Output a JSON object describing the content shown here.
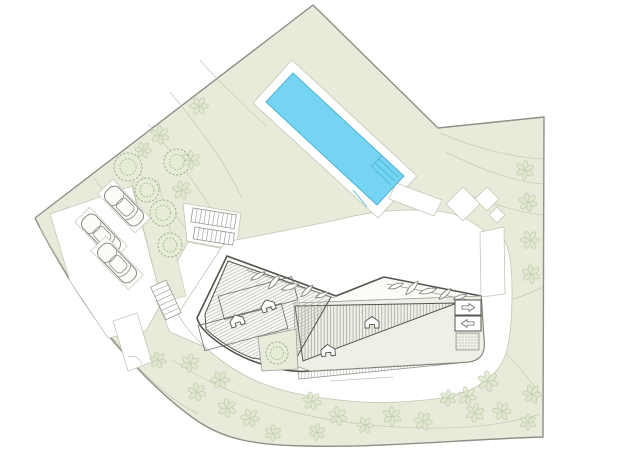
{
  "meta": {
    "canvas_width": 640,
    "canvas_height": 452
  },
  "colors": {
    "paper": "#ffffff",
    "site_green": "#e8ebd9",
    "white": "#ffffff",
    "pool_blue": "#74d4f2",
    "pool_line": "#4fb3d4",
    "boundary": "#8f8f88",
    "line_light": "#c2c7b5",
    "line_mid": "#9a9a92",
    "line_dark": "#54544e",
    "hatch": "#a9a9a1",
    "stripe2": "#b3b3ab",
    "tree_detail": "#9fae8e",
    "tree_detail_fill": "#e6ecd6",
    "tree_light": "#bcc7aa",
    "tree_light_fill": "#e0e8cd",
    "building_fill": "#fbfbf8",
    "plain_roof": "#efefe8",
    "car_stroke": "#8a8a84"
  },
  "site": {
    "outline": "M313,5 L438,128 L544,117 L543,437 C470,439 380,448 305,446 C250,445 222,438 196,420 C163,397 130,362 104,330 C82,302 52,252 35,218 Z",
    "inner_wall": "M40,227 C64,272 95,318 124,352 C152,384 175,402 198,414"
  },
  "contours": [
    "M170,92 C198,126 224,160 242,198",
    "M148,124 C178,160 202,190 218,222",
    "M124,154 C156,194 178,216 192,238",
    "M94,178 C122,214 142,240 152,258",
    "M66,206 C96,246 116,270 130,290",
    "M200,60 C224,88 248,108 266,126",
    "M440,133 C472,147 510,157 543,159",
    "M446,152 C482,170 516,182 543,184",
    "M462,192 C496,206 524,213 543,215",
    "M505,302 C518,298 532,292 543,287",
    "M505,352 C520,368 532,382 541,396",
    "M172,360 C244,406 324,426 424,428 C472,429 512,423 540,414"
  ],
  "white_areas": [
    {
      "name": "parking-area",
      "d": "M50,214 L132,186 L162,302 L146,331 L108,338 L70,281 Z"
    },
    {
      "name": "corridor-path",
      "d": "M156,300 L188,242 L240,252 L212,350 L170,332 Z"
    },
    {
      "name": "stairs-pad",
      "d": "M183,203 L241,213 L236,250 L187,241 Z"
    },
    {
      "name": "entrance-structure",
      "d": "M113,321 L137,313 L152,362 L128,371 Z"
    },
    {
      "name": "driveway-and-road",
      "d": "M225,242 C268,234 310,226 345,218 C378,210 405,209 437,211 C458,213 472,221 483,230 C494,235 501,238 505,241 C510,253 512,266 512,292 C512,318 510,340 506,353 C501,369 491,379 470,390 C452,398 430,400 400,402 C368,404 328,400 294,393 C262,386 238,374 214,355 C197,341 184,326 178,314 Z"
    },
    {
      "name": "pool-deck",
      "d": "M292,60 L417,176 L378,218 L253,103 Z"
    },
    {
      "name": "walkway-chevron",
      "d": "M396,183 L442,200 L434,216 L389,199 Z"
    },
    {
      "name": "walkway-diamond-1",
      "d": "M463,187 L480,204 L463,221 L446,204 Z"
    },
    {
      "name": "walkway-diamond-2",
      "d": "M487,187 L499,199 L487,211 L475,199 Z"
    },
    {
      "name": "walkway-diamond-3",
      "d": "M497,207 L505,215 L497,223 L489,215 Z"
    },
    {
      "name": "walkway-vertical",
      "d": "M480,232 L504,227 L505,294 L481,297 Z"
    }
  ],
  "green_islands": [
    {
      "name": "tree-strip",
      "d": "M132,183 L158,180 L186,296 L162,302 Z"
    }
  ],
  "entrance_arc": "M128,357 A11,11 0 0 1 142,364",
  "pool": {
    "body": "M293,73 L404,176 L377,205 L266,102 Z",
    "detail_lines": [
      "M379,159 L398,177",
      "M375,163 L395,181",
      "M372,167 L391,185",
      "M382,155 L371,167",
      "M353,190 L367,207"
    ]
  },
  "building": {
    "lower_band": "M298,366 L458,350 L459,363 L299,379 Z",
    "lower_edge_line": "M330,381 L393,377",
    "outer": "M197,318 L227,256 L336,296 L384,277 L481,296 L484,343 C485,356 477,361 467,362 L310,371 C290,373 268,367 250,360 C230,352 212,339 204,330 C199,325 197,318 197,318 Z",
    "plain_right": "M294,303 L481,296 L484,343 C485,356 477,361 467,362 L310,371 L296,366 Z",
    "stripes_tri": "M295,306 L457,303 L303,361 Z",
    "hatch_wing": "M205,314 L228,261 L331,297 L293,364 L252,358 C233,351 215,338 206,329 Z",
    "inner_rects": [
      {
        "cx": 258,
        "cy": 298,
        "w": 76,
        "h": 24,
        "rot": -15
      },
      {
        "cx": 243,
        "cy": 327,
        "w": 86,
        "h": 26,
        "rot": -15
      }
    ],
    "leaf_lines": [
      "M246,270 L335,298",
      "M387,284 L469,300"
    ],
    "leaves": [
      {
        "x": 258,
        "y": 276,
        "r": -30,
        "s": 8
      },
      {
        "x": 274,
        "y": 282,
        "r": -52,
        "s": 9
      },
      {
        "x": 290,
        "y": 287,
        "r": -18,
        "s": 9
      },
      {
        "x": 307,
        "y": 291,
        "r": -45,
        "s": 8
      },
      {
        "x": 322,
        "y": 295,
        "r": -22,
        "s": 7
      },
      {
        "x": 396,
        "y": 286,
        "r": -20,
        "s": 8
      },
      {
        "x": 412,
        "y": 288,
        "r": -48,
        "s": 9
      },
      {
        "x": 428,
        "y": 291,
        "r": -15,
        "s": 9
      },
      {
        "x": 445,
        "y": 294,
        "r": -42,
        "s": 8
      },
      {
        "x": 460,
        "y": 297,
        "r": -18,
        "s": 7
      }
    ],
    "courtyard": "M258,337 L296,329 L298,369 L262,371 Z",
    "roof_hatches": [
      {
        "x": 237,
        "y": 321,
        "rot": -20
      },
      {
        "x": 268,
        "y": 306,
        "rot": -20
      },
      {
        "x": 372,
        "y": 323,
        "rot": 0
      },
      {
        "x": 328,
        "y": 351,
        "rot": -5
      }
    ],
    "skylight_boxes": [
      {
        "x": 455,
        "y": 300,
        "w": 26,
        "h": 15,
        "dir": "right"
      },
      {
        "x": 455,
        "y": 316,
        "w": 26,
        "h": 15,
        "dir": "left"
      }
    ],
    "stipple": {
      "x": 456,
      "y": 333,
      "w": 23,
      "h": 17
    }
  },
  "stairs": [
    {
      "x": 193,
      "y": 208,
      "angle": 9,
      "len": 44,
      "w": 14,
      "steps": 10
    },
    {
      "x": 195,
      "y": 227,
      "angle": 9,
      "len": 40,
      "w": 12,
      "steps": 9
    },
    {
      "x": 166,
      "y": 280,
      "angle": 65,
      "len": 36,
      "w": 17,
      "steps": 7
    }
  ],
  "cars": [
    {
      "x": 101,
      "y": 234,
      "rot": 46
    },
    {
      "x": 117,
      "y": 263,
      "rot": 46
    },
    {
      "x": 124,
      "y": 206,
      "rot": 46
    }
  ],
  "trees": {
    "detailed": [
      [
        128,
        167,
        14
      ],
      [
        177,
        162,
        13
      ],
      [
        147,
        190,
        12
      ],
      [
        163,
        213,
        13
      ],
      [
        170,
        245,
        12
      ],
      [
        277,
        353,
        11
      ]
    ],
    "light": [
      [
        199,
        106,
        9
      ],
      [
        160,
        135,
        9
      ],
      [
        143,
        150,
        8
      ],
      [
        191,
        160,
        9
      ],
      [
        182,
        190,
        9
      ],
      [
        525,
        170,
        9
      ],
      [
        528,
        202,
        9
      ],
      [
        530,
        240,
        9
      ],
      [
        531,
        274,
        9
      ],
      [
        532,
        394,
        9
      ],
      [
        528,
        422,
        8
      ],
      [
        158,
        360,
        8
      ],
      [
        190,
        363,
        9
      ],
      [
        197,
        392,
        9
      ],
      [
        220,
        380,
        9
      ],
      [
        227,
        408,
        9
      ],
      [
        250,
        418,
        9
      ],
      [
        273,
        433,
        8
      ],
      [
        312,
        401,
        9
      ],
      [
        317,
        432,
        8
      ],
      [
        338,
        416,
        9
      ],
      [
        365,
        425,
        8
      ],
      [
        392,
        416,
        9
      ],
      [
        423,
        421,
        9
      ],
      [
        448,
        398,
        8
      ],
      [
        467,
        396,
        9
      ],
      [
        475,
        413,
        9
      ],
      [
        488,
        381,
        10
      ],
      [
        502,
        411,
        9
      ]
    ]
  }
}
